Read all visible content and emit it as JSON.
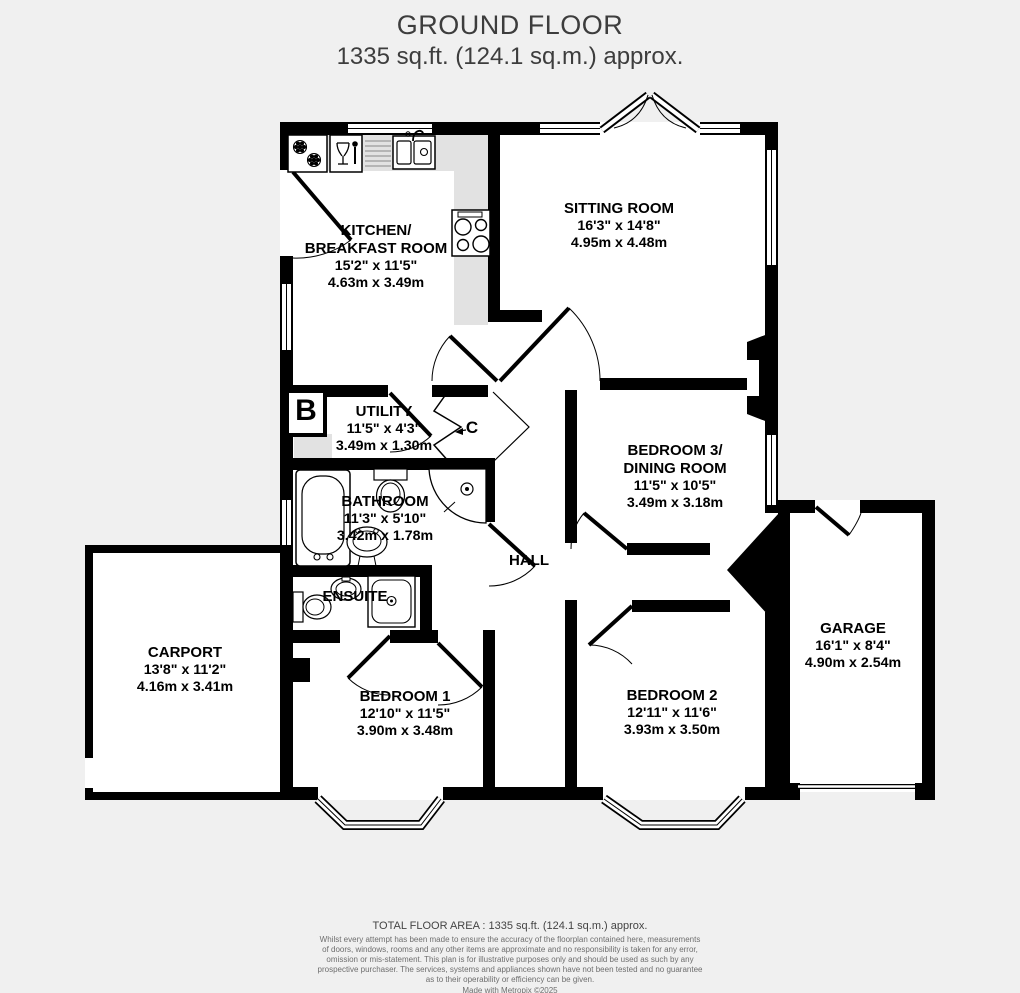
{
  "title": {
    "line1": "GROUND FLOOR",
    "line2": "1335 sq.ft. (124.1 sq.m.) approx."
  },
  "colors": {
    "wall": "#000000",
    "background": "#f0f0f0",
    "room_fill": "#ffffff",
    "counter": "#e2e2e2"
  },
  "rooms": {
    "kitchen": {
      "name1": "KITCHEN/",
      "name2": "BREAKFAST ROOM",
      "imperial": "15'2\"  x 11'5\"",
      "metric": "4.63m  x 3.49m"
    },
    "sitting": {
      "name1": "SITTING ROOM",
      "imperial": "16'3\"  x 14'8\"",
      "metric": "4.95m  x 4.48m"
    },
    "utility": {
      "name1": "UTILITY",
      "imperial": "11'5\"  x 4'3\"",
      "metric": "3.49m  x 1.30m"
    },
    "bathroom": {
      "name1": "BATHROOM",
      "imperial": "11'3\"  x 5'10\"",
      "metric": "3.42m  x 1.78m"
    },
    "bedroom3": {
      "name1": "BEDROOM 3/",
      "name2": "DINING ROOM",
      "imperial": "11'5\"  x 10'5\"",
      "metric": "3.49m  x 3.18m"
    },
    "hall": {
      "name1": "HALL"
    },
    "ensuite": {
      "name1": "ENSUITE"
    },
    "carport": {
      "name1": "CARPORT",
      "imperial": "13'8\"  x 11'2\"",
      "metric": "4.16m  x 3.41m"
    },
    "bedroom1": {
      "name1": "BEDROOM 1",
      "imperial": "12'10\"  x 11'5\"",
      "metric": "3.90m  x 3.48m"
    },
    "bedroom2": {
      "name1": "BEDROOM 2",
      "imperial": "12'11\"  x 11'6\"",
      "metric": "3.93m  x 3.50m"
    },
    "garage": {
      "name1": "GARAGE",
      "imperial": "16'1\"  x 8'4\"",
      "metric": "4.90m  x 2.54m"
    },
    "boiler_label": "B",
    "cupboard_label": "C"
  },
  "footer": {
    "total": "TOTAL FLOOR AREA : 1335 sq.ft. (124.1 sq.m.) approx.",
    "disclaimer1": "Whilst every attempt has been made to ensure the accuracy of the floorplan contained here, measurements",
    "disclaimer2": "of doors, windows, rooms and any other items are approximate and no responsibility is taken for any error,",
    "disclaimer3": "omission or mis-statement. This plan is for illustrative purposes only and should be used as such by any",
    "disclaimer4": "prospective purchaser. The services, systems and appliances shown have not been tested and no guarantee",
    "disclaimer5": "as to their operability or efficiency can be given.",
    "credit": "Made with Metropix ©2025"
  }
}
